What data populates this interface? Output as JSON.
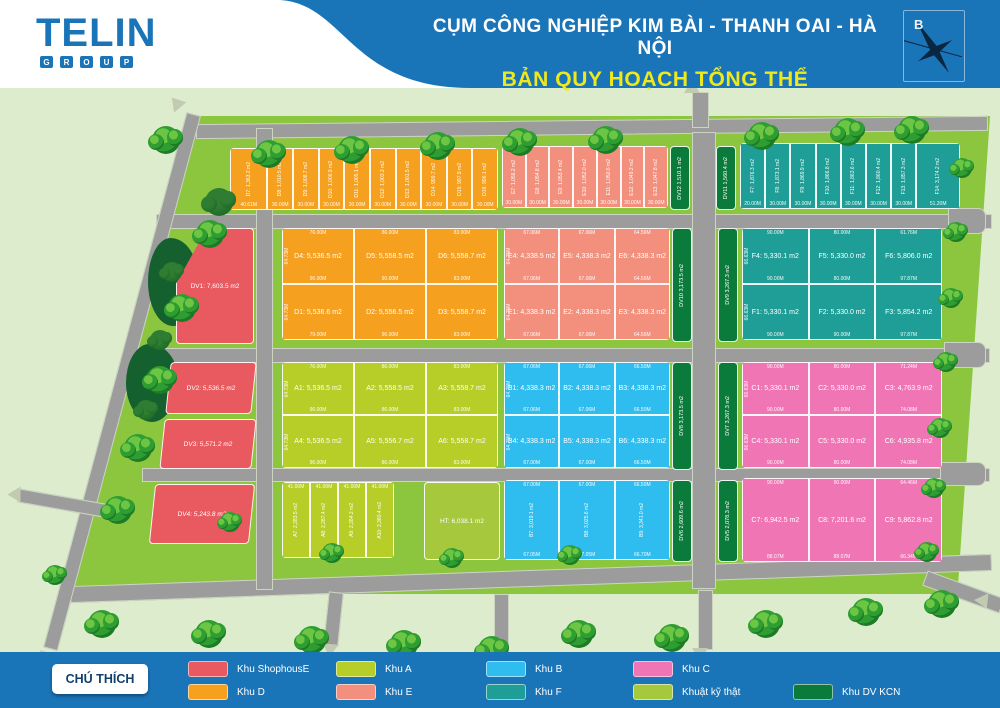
{
  "header": {
    "logo_text": "TELIN",
    "logo_sub": "GROUP",
    "title_line1": "CỤM CÔNG NGHIỆP KIM BÀI  - THANH OAI - HÀ NỘI",
    "title_line2": "BẢN QUY HOẠCH TỔNG THỂ",
    "compass_label": "B",
    "bar_color": "#1a74b8",
    "title2_color": "#efe91c"
  },
  "map": {
    "background_color": "#dceccd",
    "field_color": "#8cc63f",
    "road_color": "#9c9c9c",
    "blocks": {
      "topD": {
        "name": "Khu D",
        "color": "#F5A01E",
        "label_style": "v",
        "rows": [
          [
            {
              "label": "D7: 1,363.2 m2",
              "bottom": "40.61M",
              "flex": 1.5
            },
            {
              "label": "D8: 1,010.5 m2",
              "bottom": "30.00M"
            },
            {
              "label": "D9: 1,008.7 m2",
              "bottom": "30.00M"
            },
            {
              "label": "D10: 1,006.9 m2",
              "bottom": "30.00M"
            },
            {
              "label": "D11: 1,005.1 m2",
              "bottom": "30.00M"
            },
            {
              "label": "D12: 1,003.3 m2",
              "bottom": "30.00M"
            },
            {
              "label": "D13: 1,001.5 m2",
              "bottom": "30.00M"
            },
            {
              "label": "D14: 999.7 m2",
              "bottom": "30.00M"
            },
            {
              "label": "D15: 997.9 m2",
              "bottom": "30.00M"
            },
            {
              "label": "D16: 996.1 m2",
              "bottom": "30.00M"
            }
          ]
        ]
      },
      "topE": {
        "name": "Khu E",
        "color": "#F2907D",
        "label_style": "v",
        "rows": [
          [
            {
              "label": "E7: 1,056.2 m2",
              "bottom": "30.00M"
            },
            {
              "label": "E8: 1,054.8 m2",
              "bottom": "30.00M"
            },
            {
              "label": "E9: 1,053.4 m2",
              "bottom": "30.00M"
            },
            {
              "label": "E10: 1,052.0 m2",
              "bottom": "30.00M"
            },
            {
              "label": "E11: 1,050.6 m2",
              "bottom": "30.00M"
            },
            {
              "label": "E12: 1,049.2 m2",
              "bottom": "30.00M"
            },
            {
              "label": "E13: 1,047.8 m2",
              "bottom": "30.00M"
            }
          ]
        ]
      },
      "topF": {
        "name": "Khu F",
        "color": "#1E9E96",
        "label_style": "v",
        "rows": [
          [
            {
              "label": "F7: 1,876.3 m2",
              "bottom": "20.00M"
            },
            {
              "label": "F8: 1,873.1 m2",
              "bottom": "30.00M"
            },
            {
              "label": "F9: 1,869.9 m2",
              "bottom": "30.00M"
            },
            {
              "label": "F10: 1,866.8 m2",
              "bottom": "30.00M"
            },
            {
              "label": "F11: 1,863.6 m2",
              "bottom": "30.00M"
            },
            {
              "label": "F12: 1,860.4 m2",
              "bottom": "30.00M"
            },
            {
              "label": "F13: 1,857.3 m2",
              "bottom": "30.00M"
            },
            {
              "label": "F14: 3,174.2 m2",
              "bottom": "51.20M",
              "flex": 1.8
            }
          ]
        ]
      },
      "blockD": {
        "name": "Khu D",
        "color": "#F5A01E",
        "label_style": "h",
        "rows": [
          [
            {
              "label": "D4: 5,536.5 m2",
              "top": "76.00M",
              "bottom": "96.00M",
              "side": "64.73M"
            },
            {
              "label": "D5: 5,558.5 m2",
              "top": "86.00M",
              "bottom": "90.00M"
            },
            {
              "label": "D6: 5,558.7 m2",
              "top": "83.00M",
              "bottom": "83.00M"
            }
          ],
          [
            {
              "label": "D1: 5,536.6 m2",
              "bottom": "79.00M",
              "side": "64.73M"
            },
            {
              "label": "D2: 5,556.5 m2",
              "bottom": "96.00M"
            },
            {
              "label": "D3: 5,558.7 m2",
              "bottom": "83.00M"
            }
          ]
        ]
      },
      "blockE": {
        "name": "Khu E",
        "color": "#F2907D",
        "label_style": "h",
        "rows": [
          [
            {
              "label": "E4: 4,338.5 m2",
              "top": "67.06M",
              "bottom": "67.06M",
              "side": "64.75M"
            },
            {
              "label": "E5: 4,338.3 m2",
              "top": "67.06M",
              "bottom": "67.06M"
            },
            {
              "label": "E6: 4,338.3 m2",
              "top": "64.56M",
              "bottom": "64.56M"
            }
          ],
          [
            {
              "label": "E1: 4,338.3 m2",
              "bottom": "67.06M",
              "side": "64.75M"
            },
            {
              "label": "E2: 4,338.3 m2",
              "bottom": "67.06M"
            },
            {
              "label": "E3: 4,338.3 m2",
              "bottom": "64.56M"
            }
          ]
        ]
      },
      "blockF": {
        "name": "Khu F",
        "color": "#1E9E96",
        "label_style": "h",
        "rows": [
          [
            {
              "label": "F4: 5,330.1 m2",
              "top": "90.00M",
              "bottom": "90.00M",
              "side": "66.63M"
            },
            {
              "label": "F5: 5,330.0 m2",
              "top": "80.00M",
              "bottom": "80.00M"
            },
            {
              "label": "F6: 5,806.0 m2",
              "top": "61.76M",
              "bottom": "97.87M"
            }
          ],
          [
            {
              "label": "F1: 5,330.1 m2",
              "bottom": "90.00M",
              "side": "66.63M"
            },
            {
              "label": "F2: 5,330.0 m2",
              "bottom": "90.00M"
            },
            {
              "label": "F3: 5,854.2 m2",
              "bottom": "97.87M"
            }
          ]
        ]
      },
      "blockA": {
        "name": "Khu A",
        "color": "#B6CE27",
        "label_style": "h",
        "rows": [
          [
            {
              "label": "A1: 5,536.5 m2",
              "top": "76.00M",
              "bottom": "96.00M",
              "side": "64.73M"
            },
            {
              "label": "A2: 5,558.5 m2",
              "top": "86.00M",
              "bottom": "86.00M"
            },
            {
              "label": "A3: 5,558.7 m2",
              "top": "83.00M",
              "bottom": "83.00M"
            }
          ],
          [
            {
              "label": "A4: 5,536.5 m2",
              "bottom": "96.00M",
              "side": "64.73M"
            },
            {
              "label": "A5: 5,556.7 m2",
              "bottom": "86.00M"
            },
            {
              "label": "A6: 5,558.7 m2",
              "bottom": "83.00M"
            }
          ]
        ]
      },
      "blockB": {
        "name": "Khu B",
        "color": "#2FBDEF",
        "label_style": "h",
        "rows": [
          [
            {
              "label": "B1: 4,338.3 m2",
              "top": "67.06M",
              "bottom": "67.06M",
              "side": "64.75M"
            },
            {
              "label": "B2: 4,338.3 m2",
              "top": "67.06M",
              "bottom": "67.06M"
            },
            {
              "label": "B3: 4,338.3 m2",
              "top": "66.50M",
              "bottom": "66.50M"
            }
          ],
          [
            {
              "label": "B4: 4,338.3 m2",
              "bottom": "67.00M",
              "side": "64.75M"
            },
            {
              "label": "B5: 4,338.3 m2",
              "bottom": "67.00M"
            },
            {
              "label": "B6: 4,338.3 m2",
              "bottom": "66.50M"
            }
          ]
        ]
      },
      "blockC": {
        "name": "Khu C",
        "color": "#F075B4",
        "label_style": "h",
        "rows": [
          [
            {
              "label": "C1: 5,330.1 m2",
              "top": "90.00M",
              "bottom": "90.00M",
              "side": "66.63M"
            },
            {
              "label": "C2: 5,330.0 m2",
              "top": "80.00M",
              "bottom": "80.00M"
            },
            {
              "label": "C3: 4,763.9 m2",
              "top": "71.24M",
              "bottom": "74.08M"
            }
          ],
          [
            {
              "label": "C4: 5,330.1 m2",
              "bottom": "90.00M",
              "side": "66.63M"
            },
            {
              "label": "C5: 5,330.0 m2",
              "bottom": "80.00M"
            },
            {
              "label": "C6: 4,935.8 m2",
              "bottom": "74.08M"
            }
          ]
        ]
      },
      "blockA710": {
        "name": "Khu A",
        "color": "#B6CE27",
        "label_style": "v",
        "rows": [
          [
            {
              "label": "A7: 2,283.5 m2",
              "top": "41.00M"
            },
            {
              "label": "A8: 2,287.4 m2",
              "top": "41.00M"
            },
            {
              "label": "A9: 2,284.2 m2",
              "top": "41.00M"
            },
            {
              "label": "A10: 2,380.4 m2",
              "top": "41.00M"
            }
          ]
        ]
      },
      "blockB79": {
        "name": "Khu B",
        "color": "#2FBDEF",
        "label_style": "v",
        "rows": [
          [
            {
              "label": "B7: 3,019.1 m2",
              "top": "67.00M",
              "bottom": "67.05M"
            },
            {
              "label": "B8: 3,025.6 m2",
              "top": "67.00M",
              "bottom": "67.05M"
            },
            {
              "label": "B9: 3,341.0 m2",
              "top": "66.50M",
              "bottom": "66.70M"
            }
          ]
        ]
      },
      "blockC79": {
        "name": "Khu C",
        "color": "#F075B4",
        "label_style": "h",
        "rows": [
          [
            {
              "label": "C7: 6,942.5 m2",
              "top": "90.00M",
              "bottom": "88.07M"
            },
            {
              "label": "C8: 7,201.6 m2",
              "top": "90.00M",
              "bottom": "88.07M"
            },
            {
              "label": "C9: 5,862.8 m2",
              "top": "64.46M",
              "bottom": "66.34M"
            }
          ]
        ]
      }
    },
    "strips": {
      "dv1": "DV1: 7,603.5 m2",
      "dv2": "DV2: 5,536.5 m2",
      "dv3": "DV3: 5,571.2 m2",
      "dv4": "DV4: 5,243.8 m2",
      "dv5": "DV5 2,078.3 m2",
      "dv6": "DV6 2,609.6 m2",
      "dv7": "DV7 3,267.3 m2",
      "dv8": "DV8 3,173.5 m2",
      "dv9": "DV9 3,267.3 m2",
      "dv10": "DV10 3,173.5 m2",
      "dv11": "DV11 1,560.4 m2",
      "dv12": "DV12 1,510.1 m2",
      "ht": "HT: 6,038.1 m2"
    }
  },
  "legend": {
    "title": "CHÚ THÍCH",
    "items": [
      {
        "key": "shophouse",
        "label": "Khu ShophousE",
        "color": "#E85960",
        "row": 1
      },
      {
        "key": "khu-a",
        "label": "Khu A",
        "color": "#B6CE27",
        "row": 1
      },
      {
        "key": "khu-b",
        "label": "Khu B",
        "color": "#2FBDEF",
        "row": 1
      },
      {
        "key": "khu-c",
        "label": "Khu C",
        "color": "#F075B4",
        "row": 1
      },
      {
        "key": "khu-d",
        "label": "Khu D",
        "color": "#F5A01E",
        "row": 2
      },
      {
        "key": "khu-e",
        "label": "Khu E",
        "color": "#F2907D",
        "row": 2
      },
      {
        "key": "khu-f",
        "label": "Khu F",
        "color": "#1E9E96",
        "row": 2
      },
      {
        "key": "ky-thuat",
        "label": "Khuật kỹ thật",
        "color": "#A6C83D",
        "row": 2
      },
      {
        "key": "dv-kcn",
        "label": "Khu DV KCN",
        "color": "#0B7B3C",
        "row": 2
      }
    ]
  }
}
